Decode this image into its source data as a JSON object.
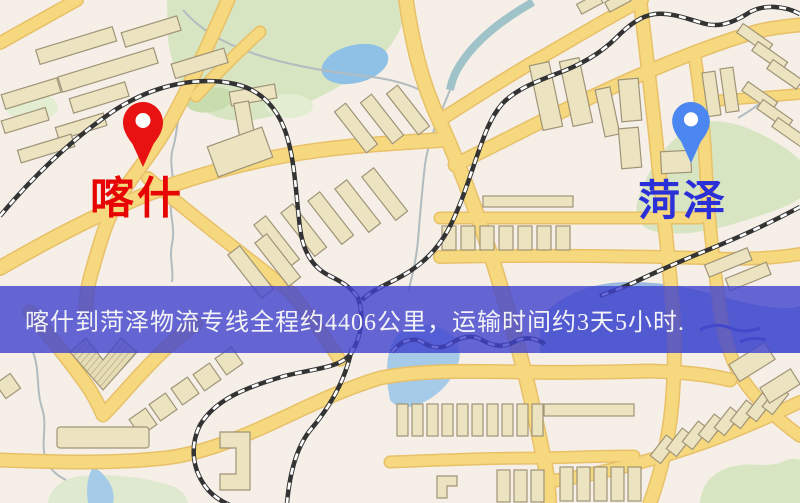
{
  "banner": {
    "text": "喀什到菏泽物流专线全程约4406公里，运输时间约3天5小时.",
    "distance": "约4406公里",
    "duration": "约3天5小时",
    "background_color": "#4042ce",
    "text_color": "#f3f3f7"
  },
  "map": {
    "origin": {
      "name": "喀什",
      "label_color": "#e60404",
      "pin_icon": "red-map-pin",
      "pin_color": "#e81212"
    },
    "destination": {
      "name": "菏泽",
      "label_color": "#2b2fd8",
      "pin_icon": "blue-map-pin",
      "pin_color": "#4c87f1"
    },
    "palette": {
      "background": "#f5efe7",
      "road_fill": "#f6d87e",
      "road_casing": "#e8c068",
      "building_fill": "#ece3c0",
      "building_outline": "#a09478",
      "park_green": "#d7e5c2",
      "water_blue": "#a5cbe9",
      "railway_dark": "#333333"
    }
  }
}
